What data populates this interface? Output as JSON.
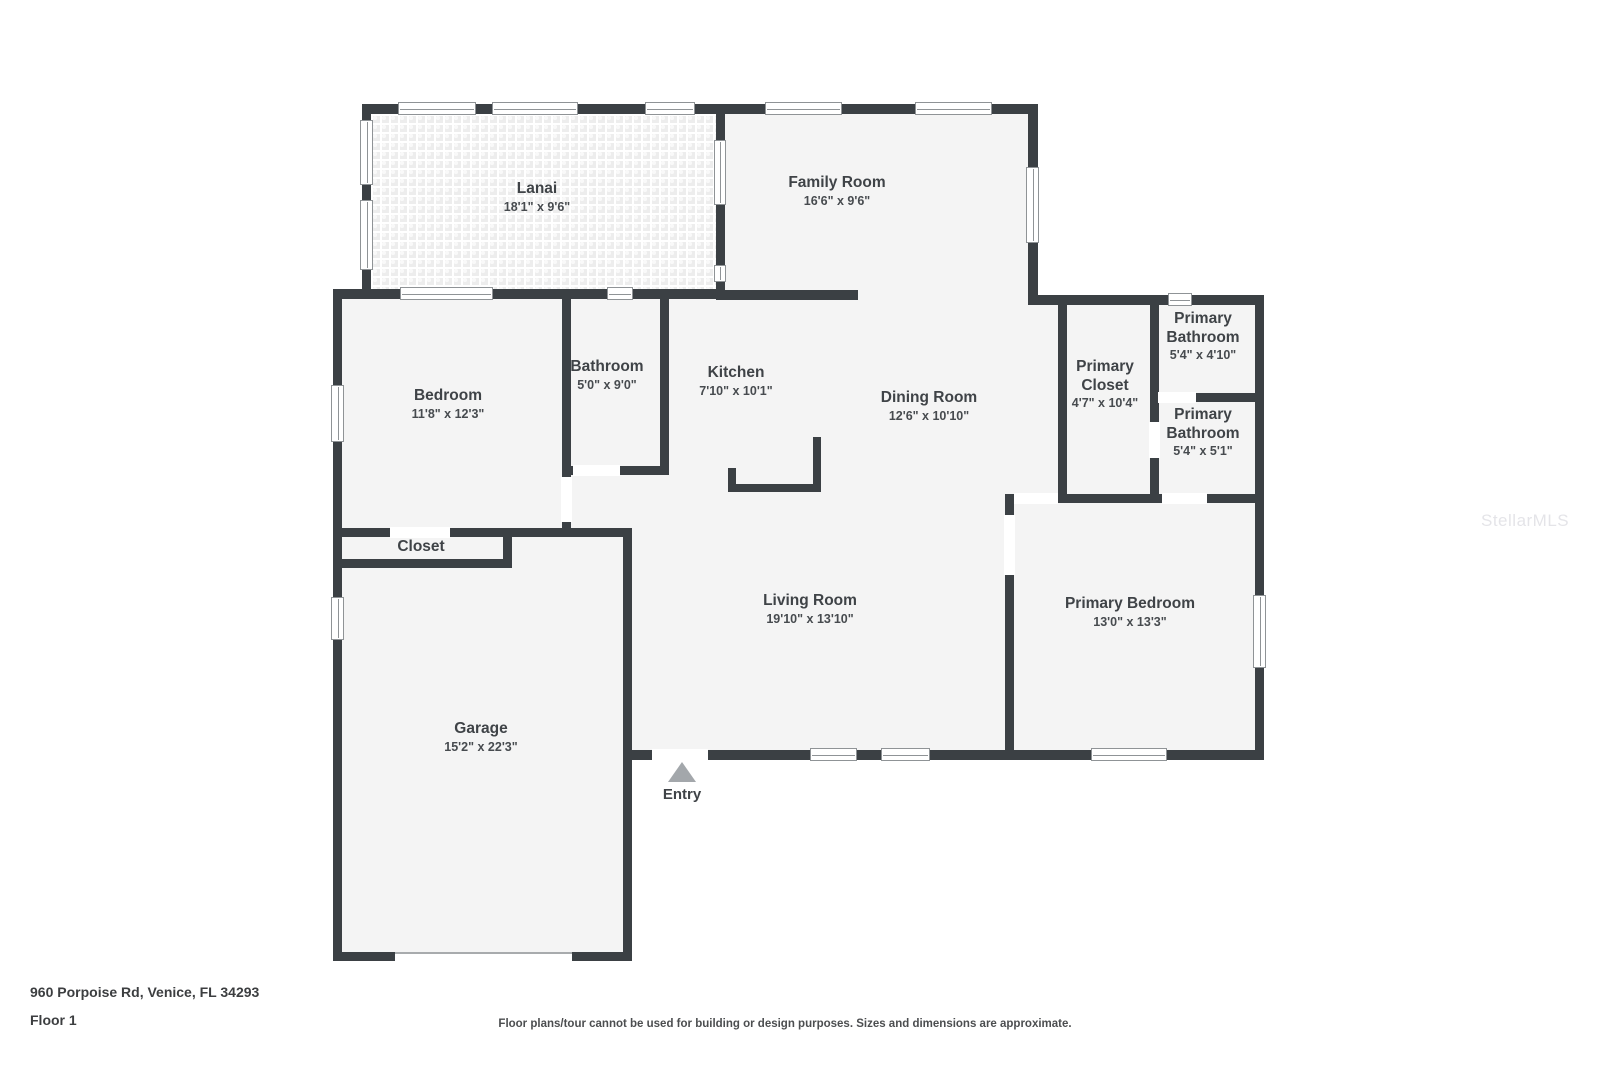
{
  "plan": {
    "address": "960 Porpoise Rd, Venice, FL 34293",
    "floor_label": "Floor 1",
    "disclaimer": "Floor plans/tour cannot be used for building or design purposes. Sizes and dimensions are approximate.",
    "watermark": "StellarMLS",
    "entry_label": "Entry",
    "rooms": [
      {
        "id": "lanai",
        "name": "Lanai",
        "dims": "18'1\" x 9'6\""
      },
      {
        "id": "family-room",
        "name": "Family Room",
        "dims": "16'6\" x 9'6\""
      },
      {
        "id": "bedroom",
        "name": "Bedroom",
        "dims": "11'8\" x 12'3\""
      },
      {
        "id": "bathroom",
        "name": "Bathroom",
        "dims": "5'0\" x 9'0\""
      },
      {
        "id": "kitchen",
        "name": "Kitchen",
        "dims": "7'10\" x 10'1\""
      },
      {
        "id": "dining-room",
        "name": "Dining Room",
        "dims": "12'6\" x 10'10\""
      },
      {
        "id": "primary-closet",
        "name": "Primary Closet",
        "dims": "4'7\" x 10'4\""
      },
      {
        "id": "primary-bathroom-1",
        "name": "Primary Bathroom",
        "dims": "5'4\" x 4'10\""
      },
      {
        "id": "primary-bathroom-2",
        "name": "Primary Bathroom",
        "dims": "5'4\" x 5'1\""
      },
      {
        "id": "closet",
        "name": "Closet",
        "dims": ""
      },
      {
        "id": "living-room",
        "name": "Living Room",
        "dims": "19'10\" x 13'10\""
      },
      {
        "id": "primary-bedroom",
        "name": "Primary Bedroom",
        "dims": "13'0\" x 13'3\""
      },
      {
        "id": "garage",
        "name": "Garage",
        "dims": "15'2\" x 22'3\""
      }
    ],
    "colors": {
      "wall": "#3b4044",
      "room_fill": "#f4f4f4",
      "label_text": "#3f4347",
      "entry_arrow": "#a3a7ab"
    }
  }
}
